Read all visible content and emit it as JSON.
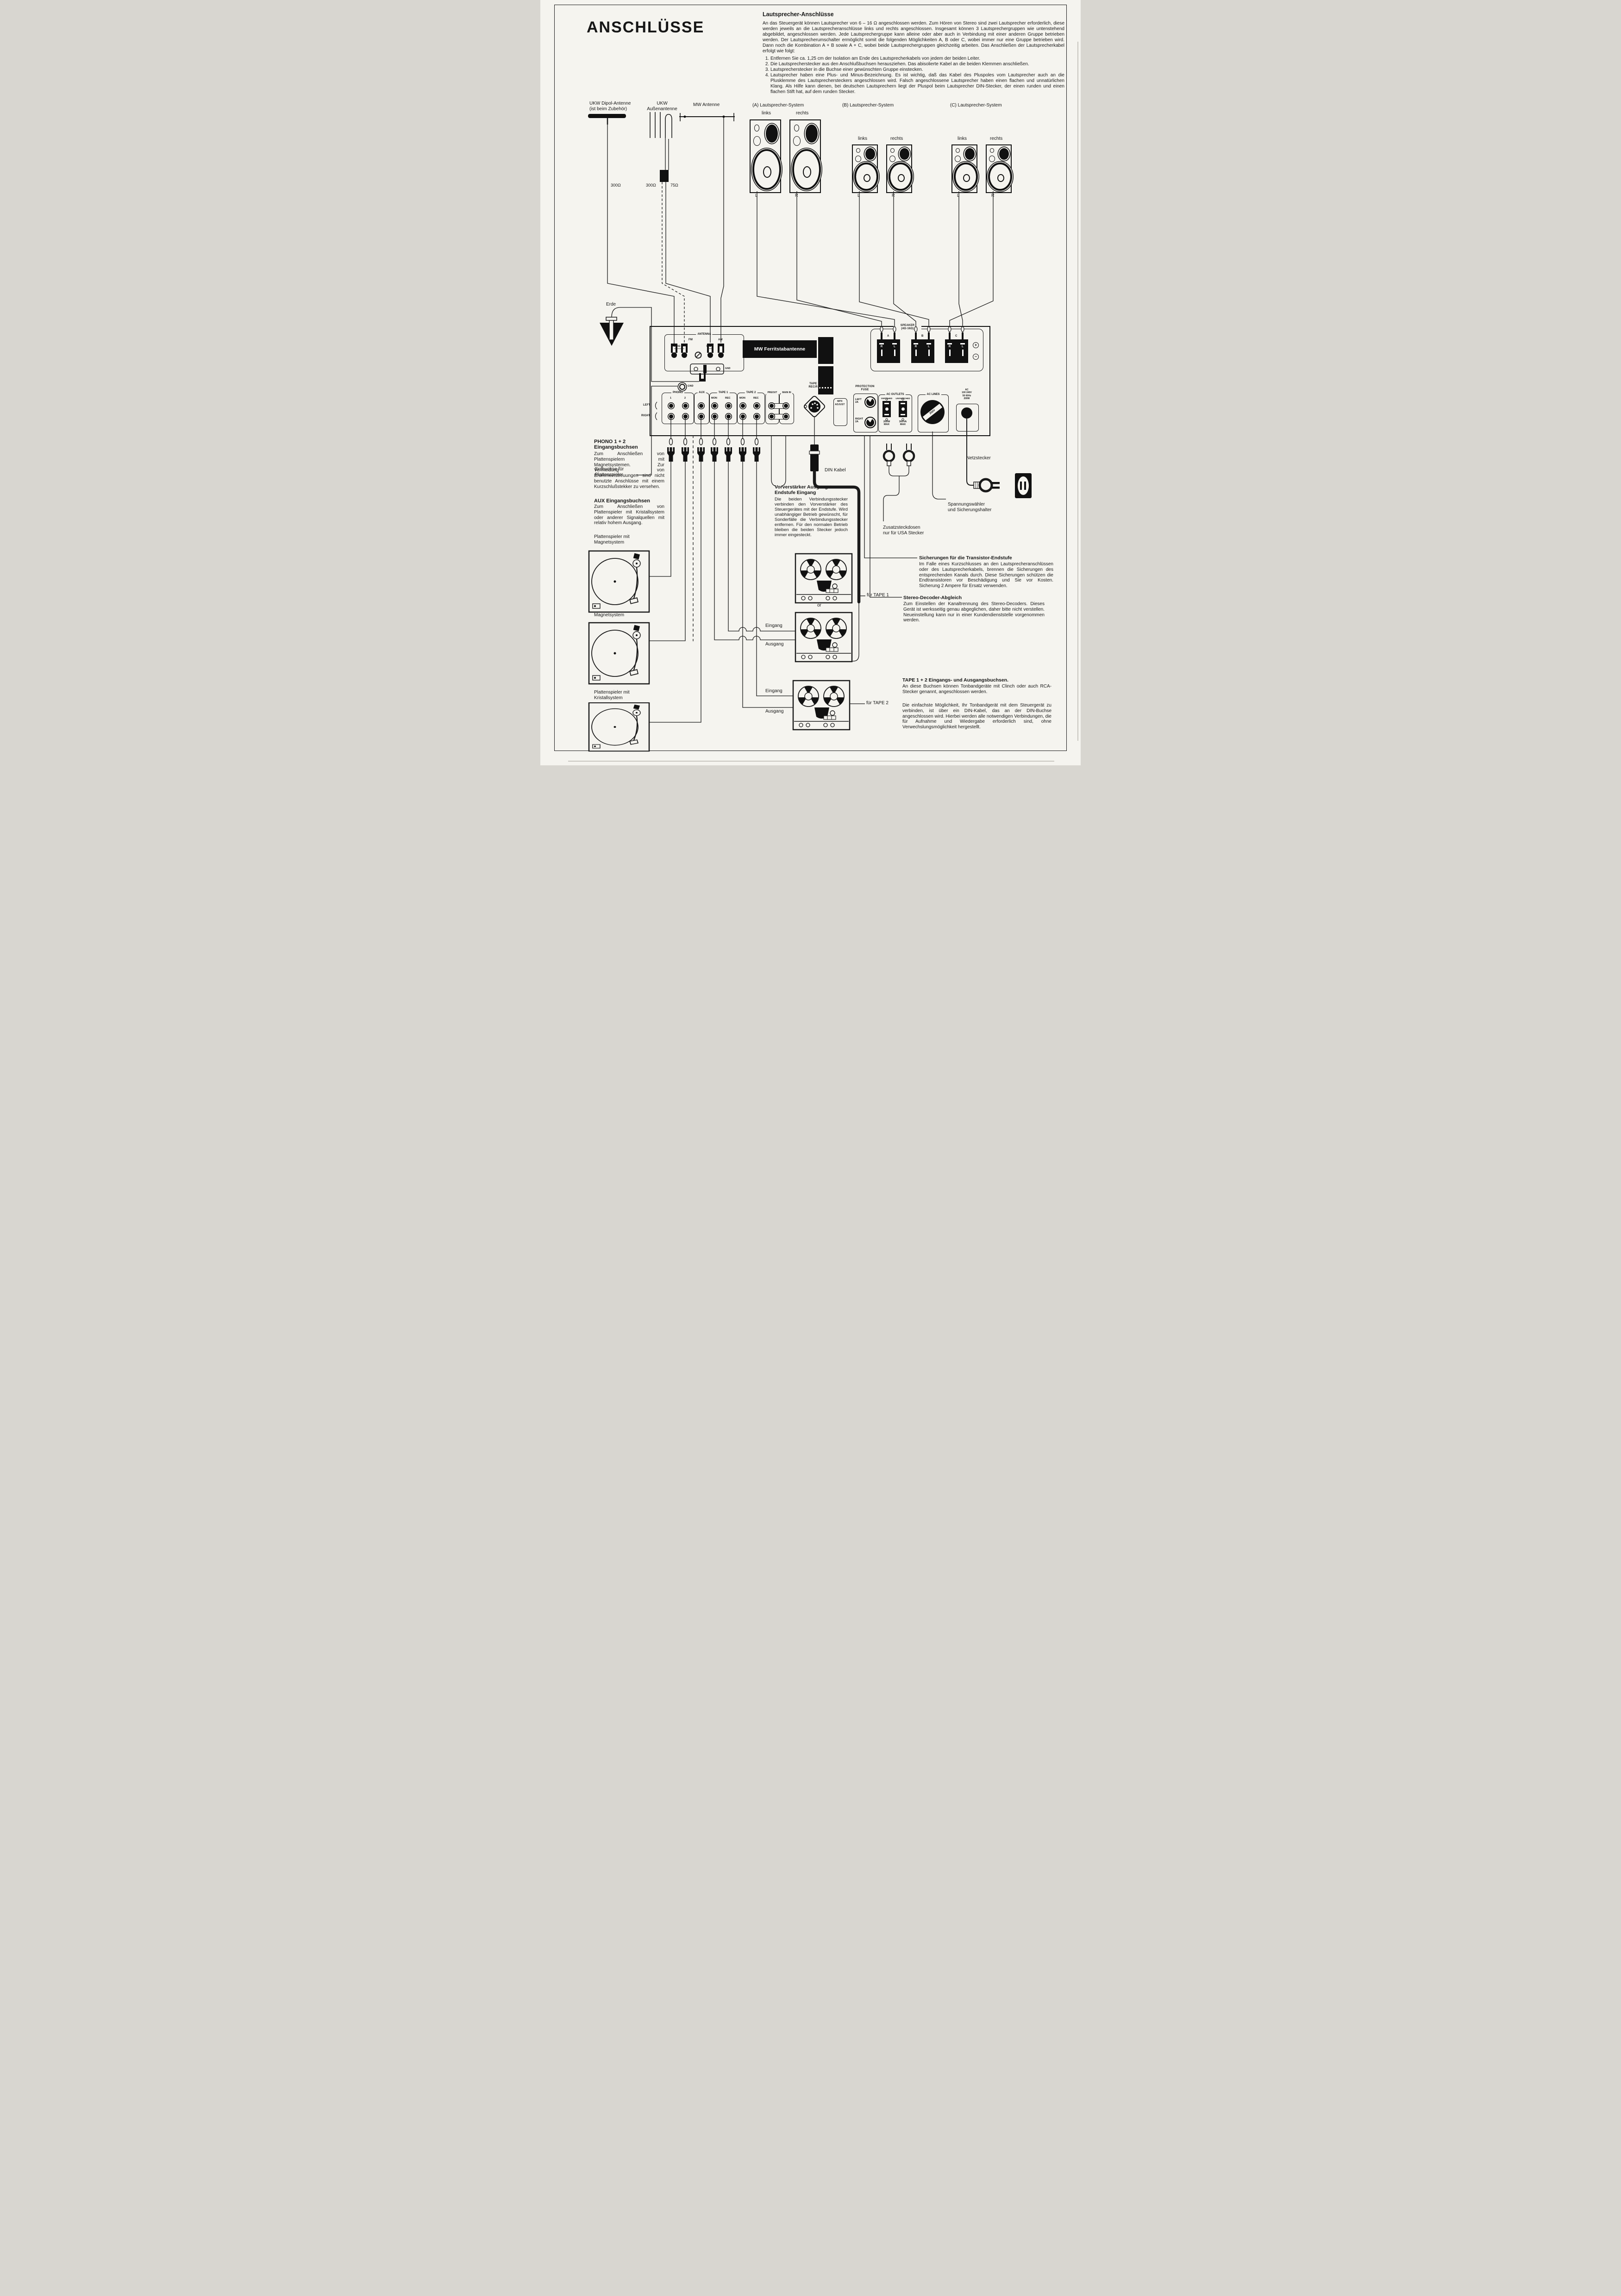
{
  "page": {
    "title": "ANSCHLÜSSE"
  },
  "instructions": {
    "heading": "Lautsprecher-Anschlüsse",
    "intro": "An das Steuergerät können Lautsprecher von 6 – 16 Ω angeschlossen werden. Zum Hören von Stereo sind zwei Lautsprecher erforderlich, diese werden jeweils an die Lautsprecheranschlüsse links und rechts angeschlossen. Insgesamt können 3 Lautsprechergruppen wie untenstehend abgebildet, angeschlossen werden. Jede Lautsprechergruppe kann alleine oder aber auch in Verbindung mit einer anderen Gruppe betrieben werden. Der Lautsprecherumschalter ermöglicht somit die folgenden Möglichkeiten A, B oder C, wobei immer nur eine Gruppe betrieben wird. Dann noch die Kombination A + B sowie A + C, wobei beide Lautsprechergruppen gleichzeitig arbeiten. Das Anschließen der Lautsprecherkabel erfolgt wie folgt:",
    "steps": [
      "Entfernen Sie ca. 1,25 cm der Isolation am Ende des Lautsprecherkabels von jedem der beiden Leiter.",
      "Die Lautsprecherstecker aus den Anschlußbuchsen herausziehen. Das abisolierte Kabel an die beiden Klemmen anschließen.",
      "Lautsprecherstecker in die Buchse einer gewünschten Gruppe einstecken.",
      "Lautsprecher haben eine Plus- und Minus-Bezeichnung. Es ist wichtig, daß das Kabel des Pluspoles vom Lautsprecher auch an die Plusklemme des Lautsprechersteckers angeschlossen wird. Falsch angeschlossene Lautsprecher haben einen flachen und unnatürlichen Klang. Als Hilfe kann dienen, bei deutschen Lautsprechern liegt der Pluspol beim Lautsprecher DIN-Stecker, der einen runden und einen flachen Stift hat, auf dem runden Stecker."
    ]
  },
  "antennas": {
    "dipole": [
      "UKW Dipol-Antenne",
      "(ist beim Zubehör)"
    ],
    "outdoor": [
      "UKW",
      "Außenantenne"
    ],
    "mw": "MW Antenne",
    "ohm_dipole": "300Ω",
    "ohm_outdoor": "300Ω",
    "ohm_75": "75Ω"
  },
  "speakers": {
    "a": "(A) Lautsprecher-System",
    "b": "(B) Lautsprecher-System",
    "c": "(C) Lautsprecher-System",
    "links": "links",
    "rechts": "rechts",
    "l": "L",
    "r": "R"
  },
  "panel": {
    "antenna": {
      "title": "ANTENNA",
      "fm": "FM",
      "ohm300": "300Ω",
      "ohm75": "75Ω",
      "am": "AM",
      "gnd": "GND"
    },
    "ferrite": "MW Ferritstabantenne",
    "speaker": {
      "title": "SPEAKER",
      "imp": "(4Ω-16Ω)",
      "a": "A",
      "b": "B",
      "c": "C",
      "r": "R",
      "l": "L",
      "plus": "+",
      "minus": "−"
    },
    "gnd": "GND",
    "phono": {
      "title": "PHONO",
      "one": "1",
      "two": "2"
    },
    "aux": "AUX",
    "tape1": {
      "title": "TAPE 1",
      "mon": "MON",
      "rec": "REC"
    },
    "tape2": {
      "title": "TAPE 2",
      "mon": "MON",
      "rec": "REC"
    },
    "preout": "PREOUT",
    "main_in": "MAIN IN",
    "left": "LEFT",
    "right": "RIGHT",
    "din": [
      "TAPE 1",
      "REC/P.B"
    ],
    "mpx": [
      "MPX",
      "ADJUST"
    ],
    "fuse": {
      "title": [
        "PROTECTION",
        "FUSE"
      ],
      "left": [
        "LEFT",
        "2A"
      ],
      "right": [
        "RIGHT",
        "2A"
      ]
    },
    "outlets": {
      "title": "AC OUTLETS",
      "switched": "SWITCHED",
      "sw_max": [
        "200W",
        "MAX"
      ],
      "unswitched": "UNSWITCHED",
      "unsw_max": [
        "300VA",
        "MAX"
      ]
    },
    "lines": {
      "title": "AC LINES",
      "voltage": "250V"
    },
    "ac": [
      "AC",
      "100 240V",
      "50 60Hz",
      "200W"
    ]
  },
  "left_col": {
    "erde": "Erde",
    "erdbuchse": [
      "Erdbuchse für",
      "Plattenspieler"
    ],
    "phono_heading": [
      "PHONO 1 + 2",
      "Eingangsbuchsen"
    ],
    "phono_body": "Zum Anschließen von Plattenspielern mit Magnetsystemen. Zur Vermeidung von Brummeinstreuungen sind nicht benutzte Anschlüsse mit einem Kurzschlußstekker zu versehen.",
    "aux_heading": "AUX Eingangsbuchsen",
    "aux_body": "Zum Anschließen von Plattenspieler mit Kristallsystem oder anderer Signalquellen mit relativ hohem Ausgang.",
    "tt1": [
      "Plattenspieler mit",
      "Magnetsystem"
    ],
    "tt2": [
      "Plattenspieler mit",
      "Magnetsystem"
    ],
    "tt3": [
      "Plattenspieler mit",
      "Kristallsystem"
    ]
  },
  "middle": {
    "din_kabel": "DIN Kabel",
    "vv_heading": [
      "Vorverstärker Ausgang +",
      "Endstufe Eingang"
    ],
    "vv_body": "Die beiden Verbindungsstecker verbinden den Vorverstärker des Steuergerätes mit der Endstufe. Wird unabhängiger Betrieb gewünscht, für Sonderfälle die Verbindungsstecker entfernen. Für den normalen Betrieb bleiben die beiden Stecker jedoch immer eingesteckt.",
    "or": "or",
    "tape1_ptr": "für TAPE 1",
    "tape2_ptr": "für TAPE 2",
    "eingang": "Eingang",
    "ausgang": "Ausgang"
  },
  "right_col": {
    "netzstecker": "Netzstecker",
    "spannung": [
      "Spannungswähler",
      "und Sicherungshalter"
    ],
    "zusatz": [
      "Zusatzsteckdosen",
      "nur für USA Stecker"
    ],
    "sich_heading": "Sicherungen für die Transistor-Endstufe",
    "sich_body": "Im Falle eines Kurzschlusses an den Lautsprecheranschlüssen oder des Lautsprecherkabels, brennen die Sicherungen des entsprechenden Kanals durch. Diese Sicherungen schützen die Endtransistoren vor Beschädigung und Sie vor Kosten. Sicherung 2 Ampere für Ersatz verwenden.",
    "stereo_heading": "Stereo-Decoder-Abgleich",
    "stereo_body": "Zum Einstellen der Kanaltrennung des Stereo-Decoders. Dieses Gerät ist werksseitig genau abgeglichen, daher bitte nicht verstellen. Neueinstellung kann nur in einer Kundendienststelle vorgenommen werden.",
    "tape_heading": "TAPE 1 + 2 Eingangs- und Ausgangsbuchsen.",
    "tape_body1": "An diese Buchsen können Tonbandgeräte mit Clinch oder auch RCA-Stecker genannt, angeschlossen werden.",
    "tape_body2": "Die einfachste Möglichkeit, Ihr Tonbandgerät mit dem Steuergerät zu verbinden, ist über ein DIN-Kabel, das an der DIN-Buchse angeschlossen wird. Hierbei werden alle notwendigen Verbindungen, die für Aufnahme und Wiedergabe erforderlich sind, ohne Verwechslungsmöglichkeit hergestellt."
  }
}
